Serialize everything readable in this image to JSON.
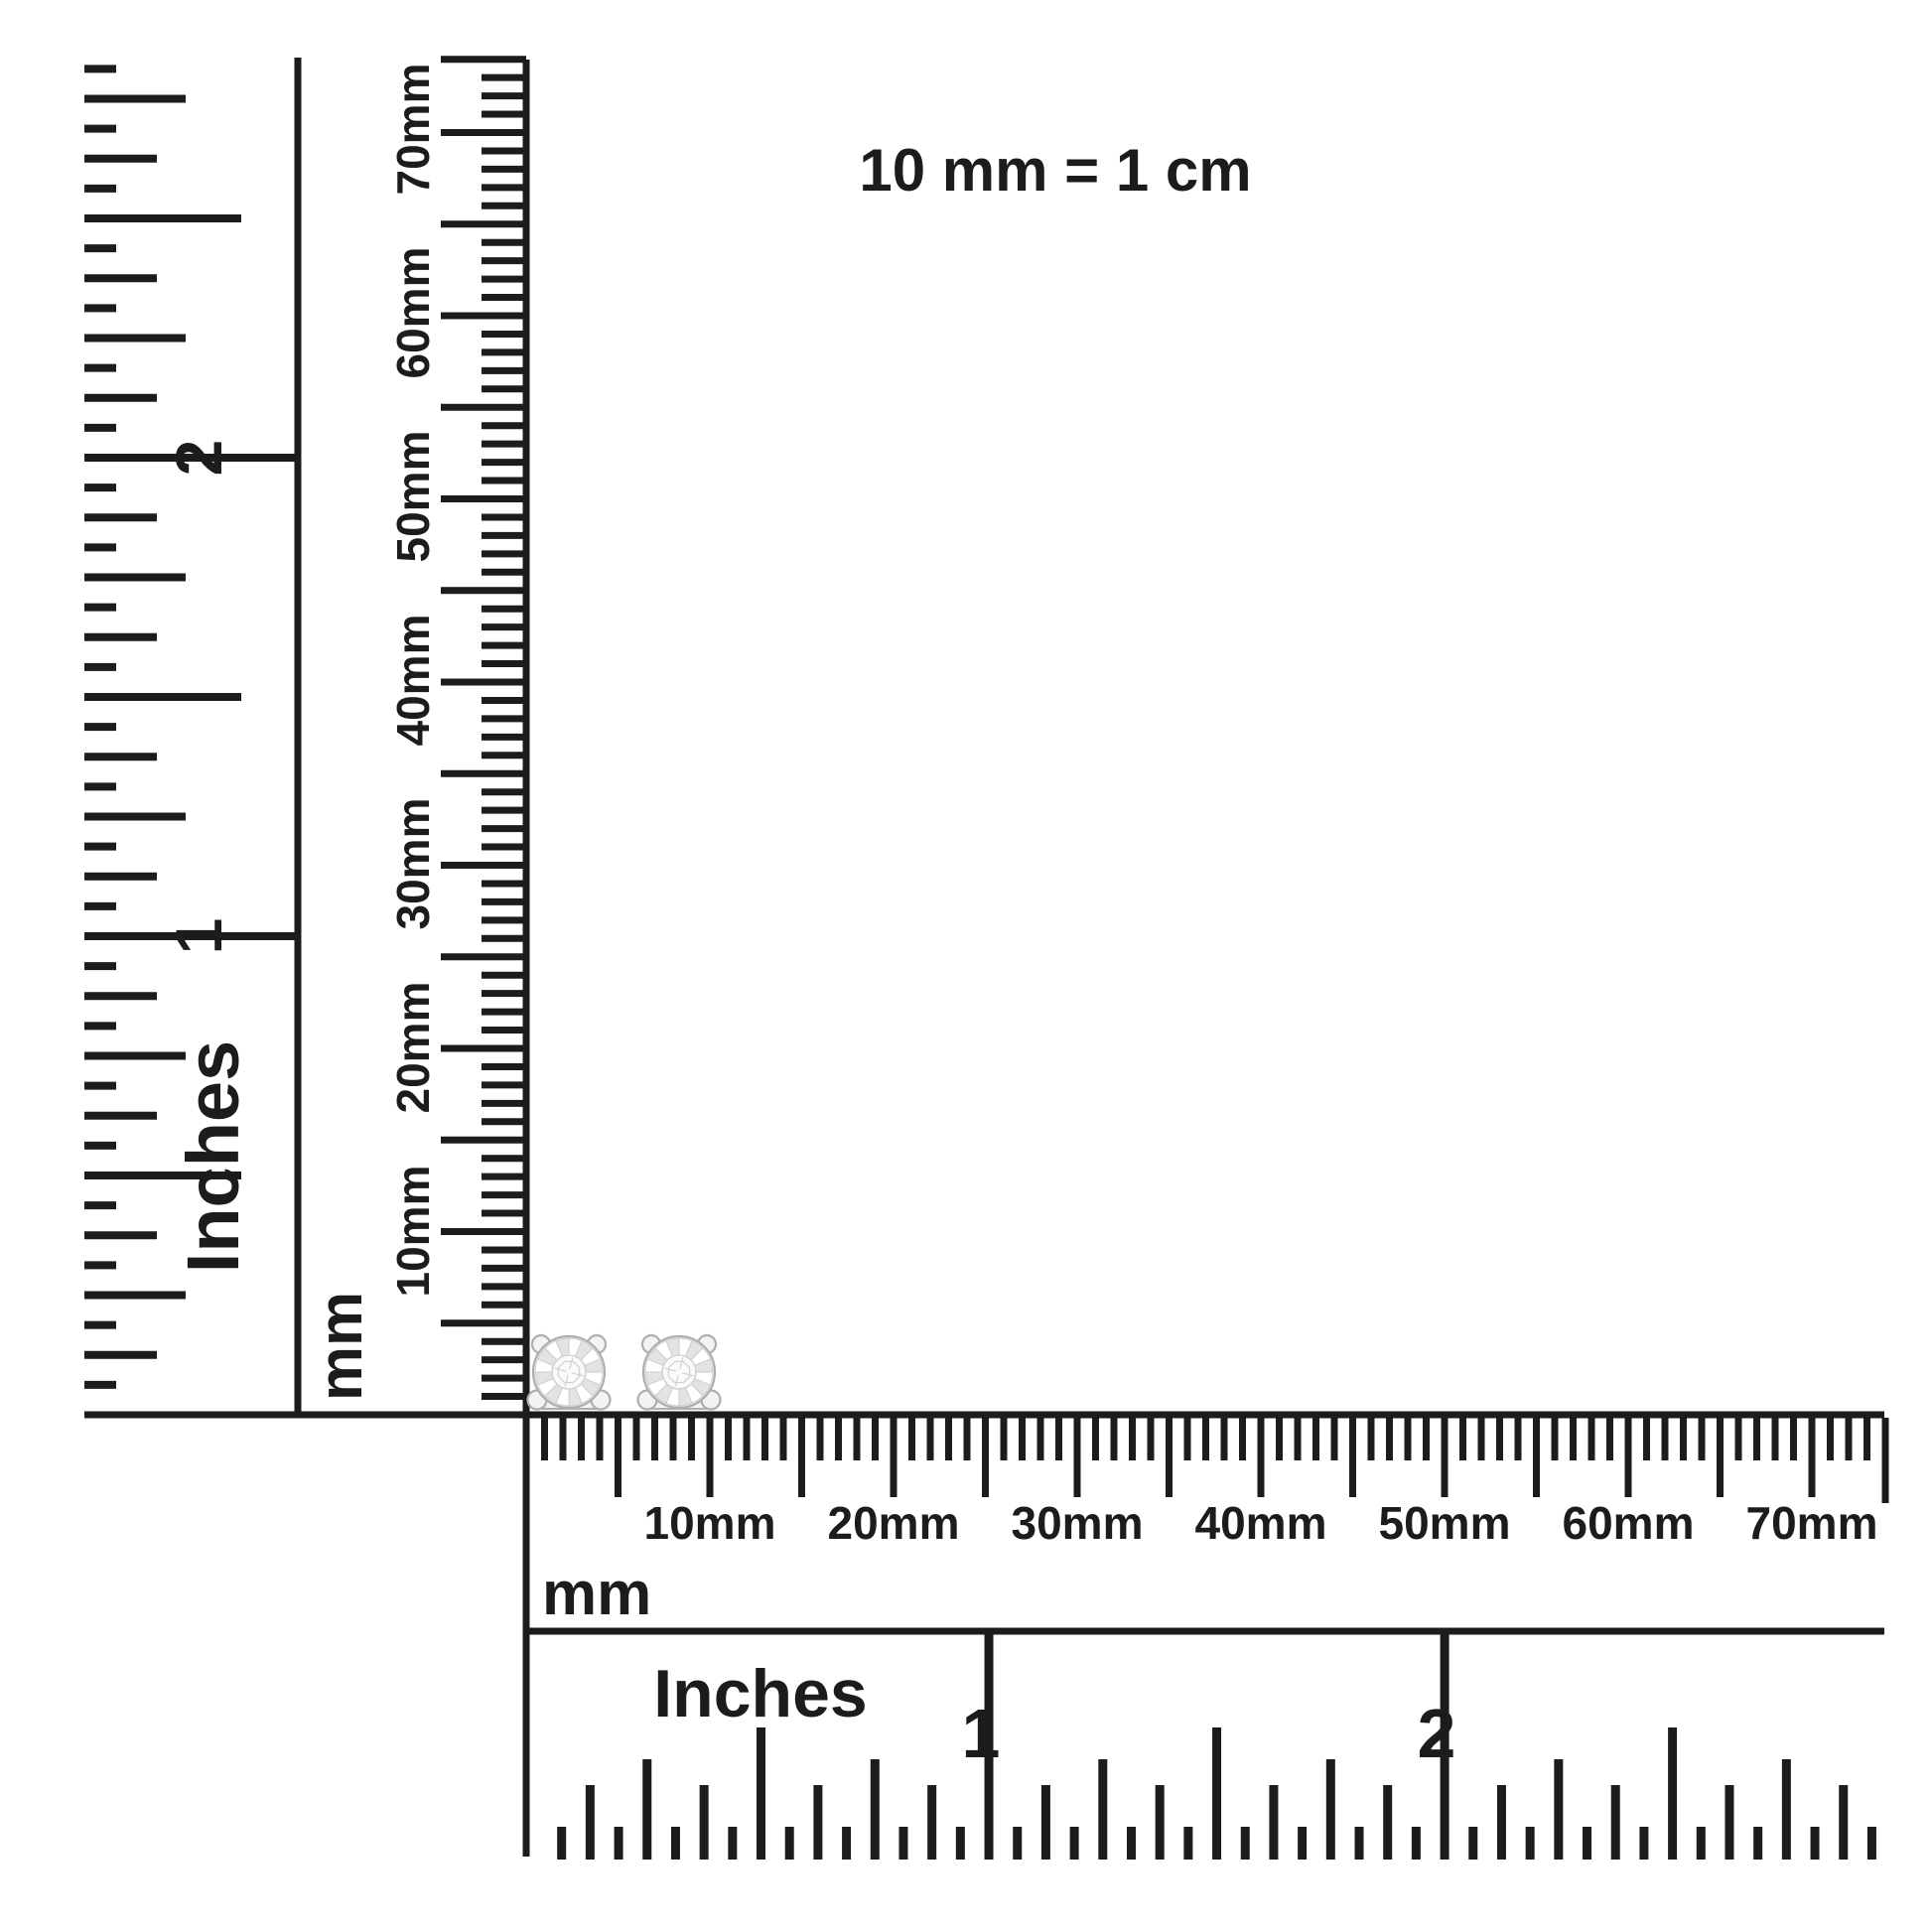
{
  "title": {
    "scale_note": "10 mm = 1 cm"
  },
  "colors": {
    "ink": "#1c1c1c",
    "paper": "#ffffff",
    "metal_outline": "#aeaeae",
    "metal_fill": "#f3f3f3",
    "facet_shade": "#e3e3e3",
    "facet_line": "#cccccc",
    "diamond_fill": "#fafafa",
    "diamond_line": "#d2d2d2"
  },
  "rulers": {
    "vertical_inches": {
      "unit": "Inches",
      "numbers": [
        "1",
        "2"
      ]
    },
    "vertical_mm": {
      "unit": "mm",
      "labels": [
        "10mm",
        "20mm",
        "30mm",
        "40mm",
        "50mm",
        "60mm",
        "70mm"
      ]
    },
    "horizontal_mm": {
      "unit": "mm",
      "labels": [
        "10mm",
        "20mm",
        "30mm",
        "40mm",
        "50mm",
        "60mm",
        "70mm"
      ]
    },
    "horizontal_inches": {
      "unit": "Inches",
      "numbers": [
        "1",
        "2"
      ]
    }
  },
  "items": {
    "earrings": {
      "name": "diamond-stud-earring",
      "count": 2
    }
  }
}
